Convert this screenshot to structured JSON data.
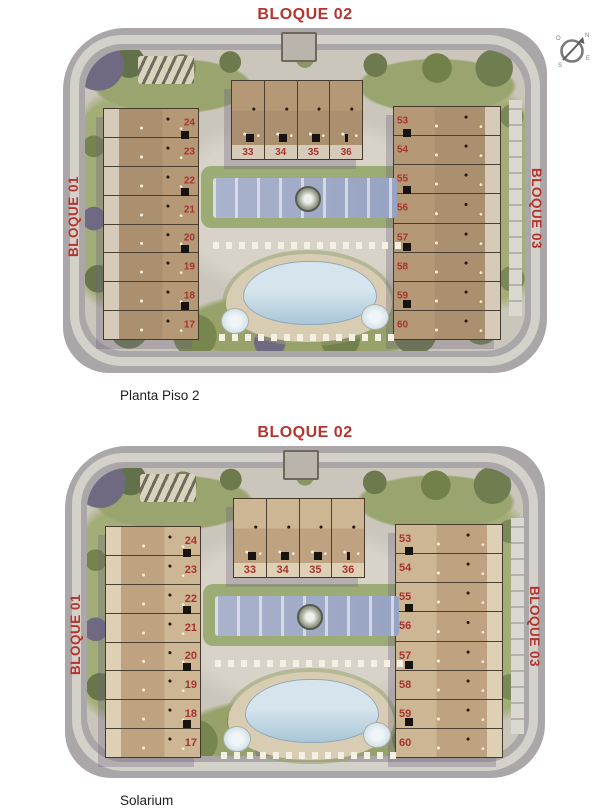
{
  "compass": {
    "n": "N",
    "o": "O",
    "e": "E",
    "s": "S"
  },
  "plans": [
    {
      "caption": "Planta Piso 2",
      "labels": {
        "top": "BLOQUE 02",
        "left": "BLOQUE 01",
        "right": "BLOQUE 03"
      },
      "left_units": [
        "24",
        "23",
        "22",
        "21",
        "20",
        "19",
        "18",
        "17"
      ],
      "center_units": [
        "33",
        "34",
        "35",
        "36"
      ],
      "right_units": [
        "53",
        "54",
        "55",
        "56",
        "57",
        "58",
        "59",
        "60"
      ]
    },
    {
      "caption": "Solarium",
      "labels": {
        "top": "BLOQUE 02",
        "left": "BLOQUE 01",
        "right": "BLOQUE 03"
      },
      "left_units": [
        "24",
        "23",
        "22",
        "21",
        "20",
        "19",
        "18",
        "17"
      ],
      "center_units": [
        "33",
        "34",
        "35",
        "36"
      ],
      "right_units": [
        "53",
        "54",
        "55",
        "56",
        "57",
        "58",
        "59",
        "60"
      ]
    }
  ],
  "colors": {
    "accent_red": "#b5342e",
    "road_gray": "#aba7a9",
    "ground_sage": "#9aa46f",
    "building_tan": "#ab9070",
    "pool_blue": "#a9c6d8"
  }
}
